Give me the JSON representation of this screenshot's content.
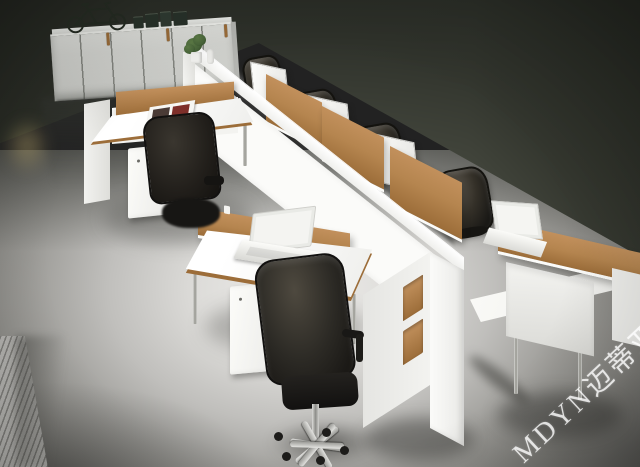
{
  "meta": {
    "title": "Office workstation system — showroom render",
    "description": "Isometric 3D render of a white modular office workstation cluster with tan desk dividers, black mesh task chairs, white mobile pedestals, a long open-shelf spine bench, laptops, a magazine, a plant, and a six-door storage cabinet topped by a bicycle, on a glossy reflective floor against a dark wall."
  },
  "watermark": {
    "text": "MDYN迈蒂亚诺",
    "color": "rgba(255,255,255,0.78)"
  },
  "palette": {
    "wall-top": "#272a24",
    "wall-mid": "#3c3f36",
    "wall-bottom": "#4b4e44",
    "floor-hi": "#eeedeb",
    "floor-mid": "#9b9a96",
    "floor-dark": "#636260",
    "white-hi": "#fbfbf9",
    "tan": "#b5854f",
    "tan-dark": "#9c6d39",
    "chair-dark": "#1a1916",
    "chrome": "#c6c6c3",
    "cabinet": "#d4d5d1",
    "plant": "#49663a"
  },
  "spine": {
    "rows": [
      [
        "tan",
        "tan",
        "white",
        "tan",
        "tan",
        "white",
        "tan"
      ],
      [
        "white",
        "white",
        "tan",
        "white",
        "white",
        "tan",
        "white"
      ]
    ]
  },
  "inventory": {
    "far_side_workstations": 4,
    "near_side_chairs": 2,
    "cabinet_doors": 6,
    "pedestal_drawers": 3,
    "laptops": 3
  }
}
